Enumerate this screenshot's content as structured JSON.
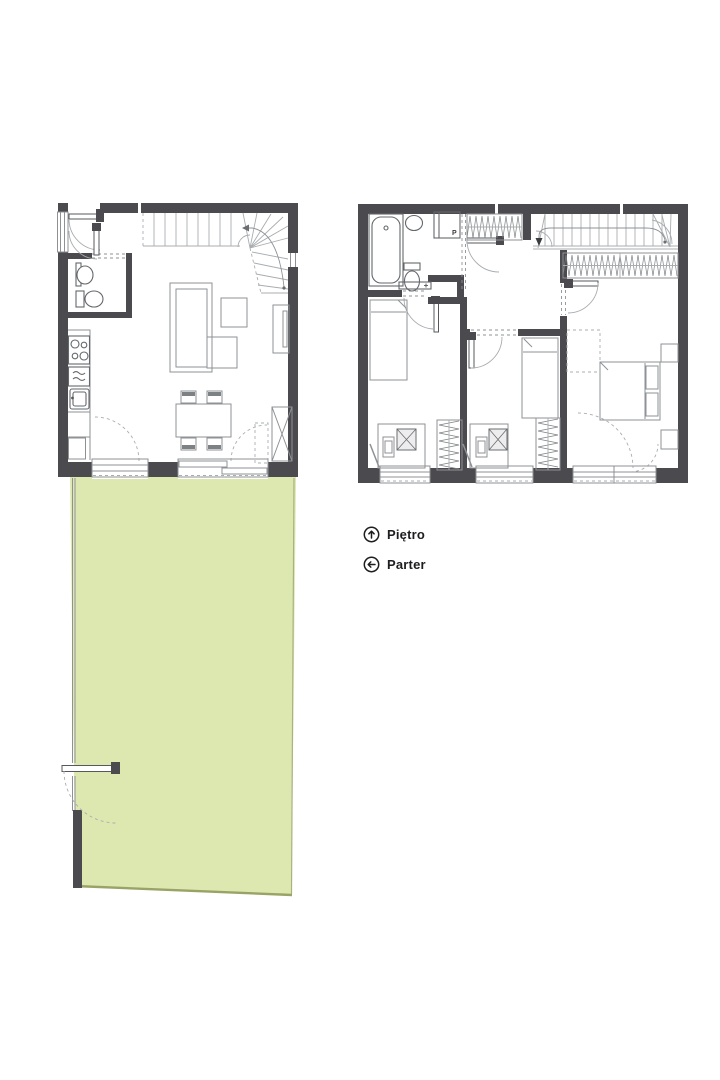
{
  "legend": {
    "items": [
      {
        "id": "upper-floor",
        "label": "Piętro",
        "icon": "arrow-up-circle-icon"
      },
      {
        "id": "ground-floor",
        "label": "Parter",
        "icon": "arrow-left-circle-icon"
      }
    ]
  },
  "plans": {
    "ground": {
      "name_ref": "Parter",
      "rooms_drawn": [
        "entry",
        "wc",
        "kitchen",
        "living-dining",
        "winder-staircase",
        "garden"
      ]
    },
    "upper": {
      "name_ref": "Piętro",
      "appliance_label": "P",
      "rooms_drawn": [
        "bathroom",
        "hall",
        "staircase",
        "bedroom-left",
        "bedroom-middle",
        "bedroom-master"
      ]
    }
  },
  "colors": {
    "background": "#ffffff",
    "wall": "#4b4b4f",
    "drawing_line": "#8e9296",
    "fixture_line": "#63686c",
    "dashed_line": "#a9adb0",
    "garden_fill": "#dde8b1",
    "garden_edge": "#99a366",
    "label_text": "#1e1e21"
  }
}
